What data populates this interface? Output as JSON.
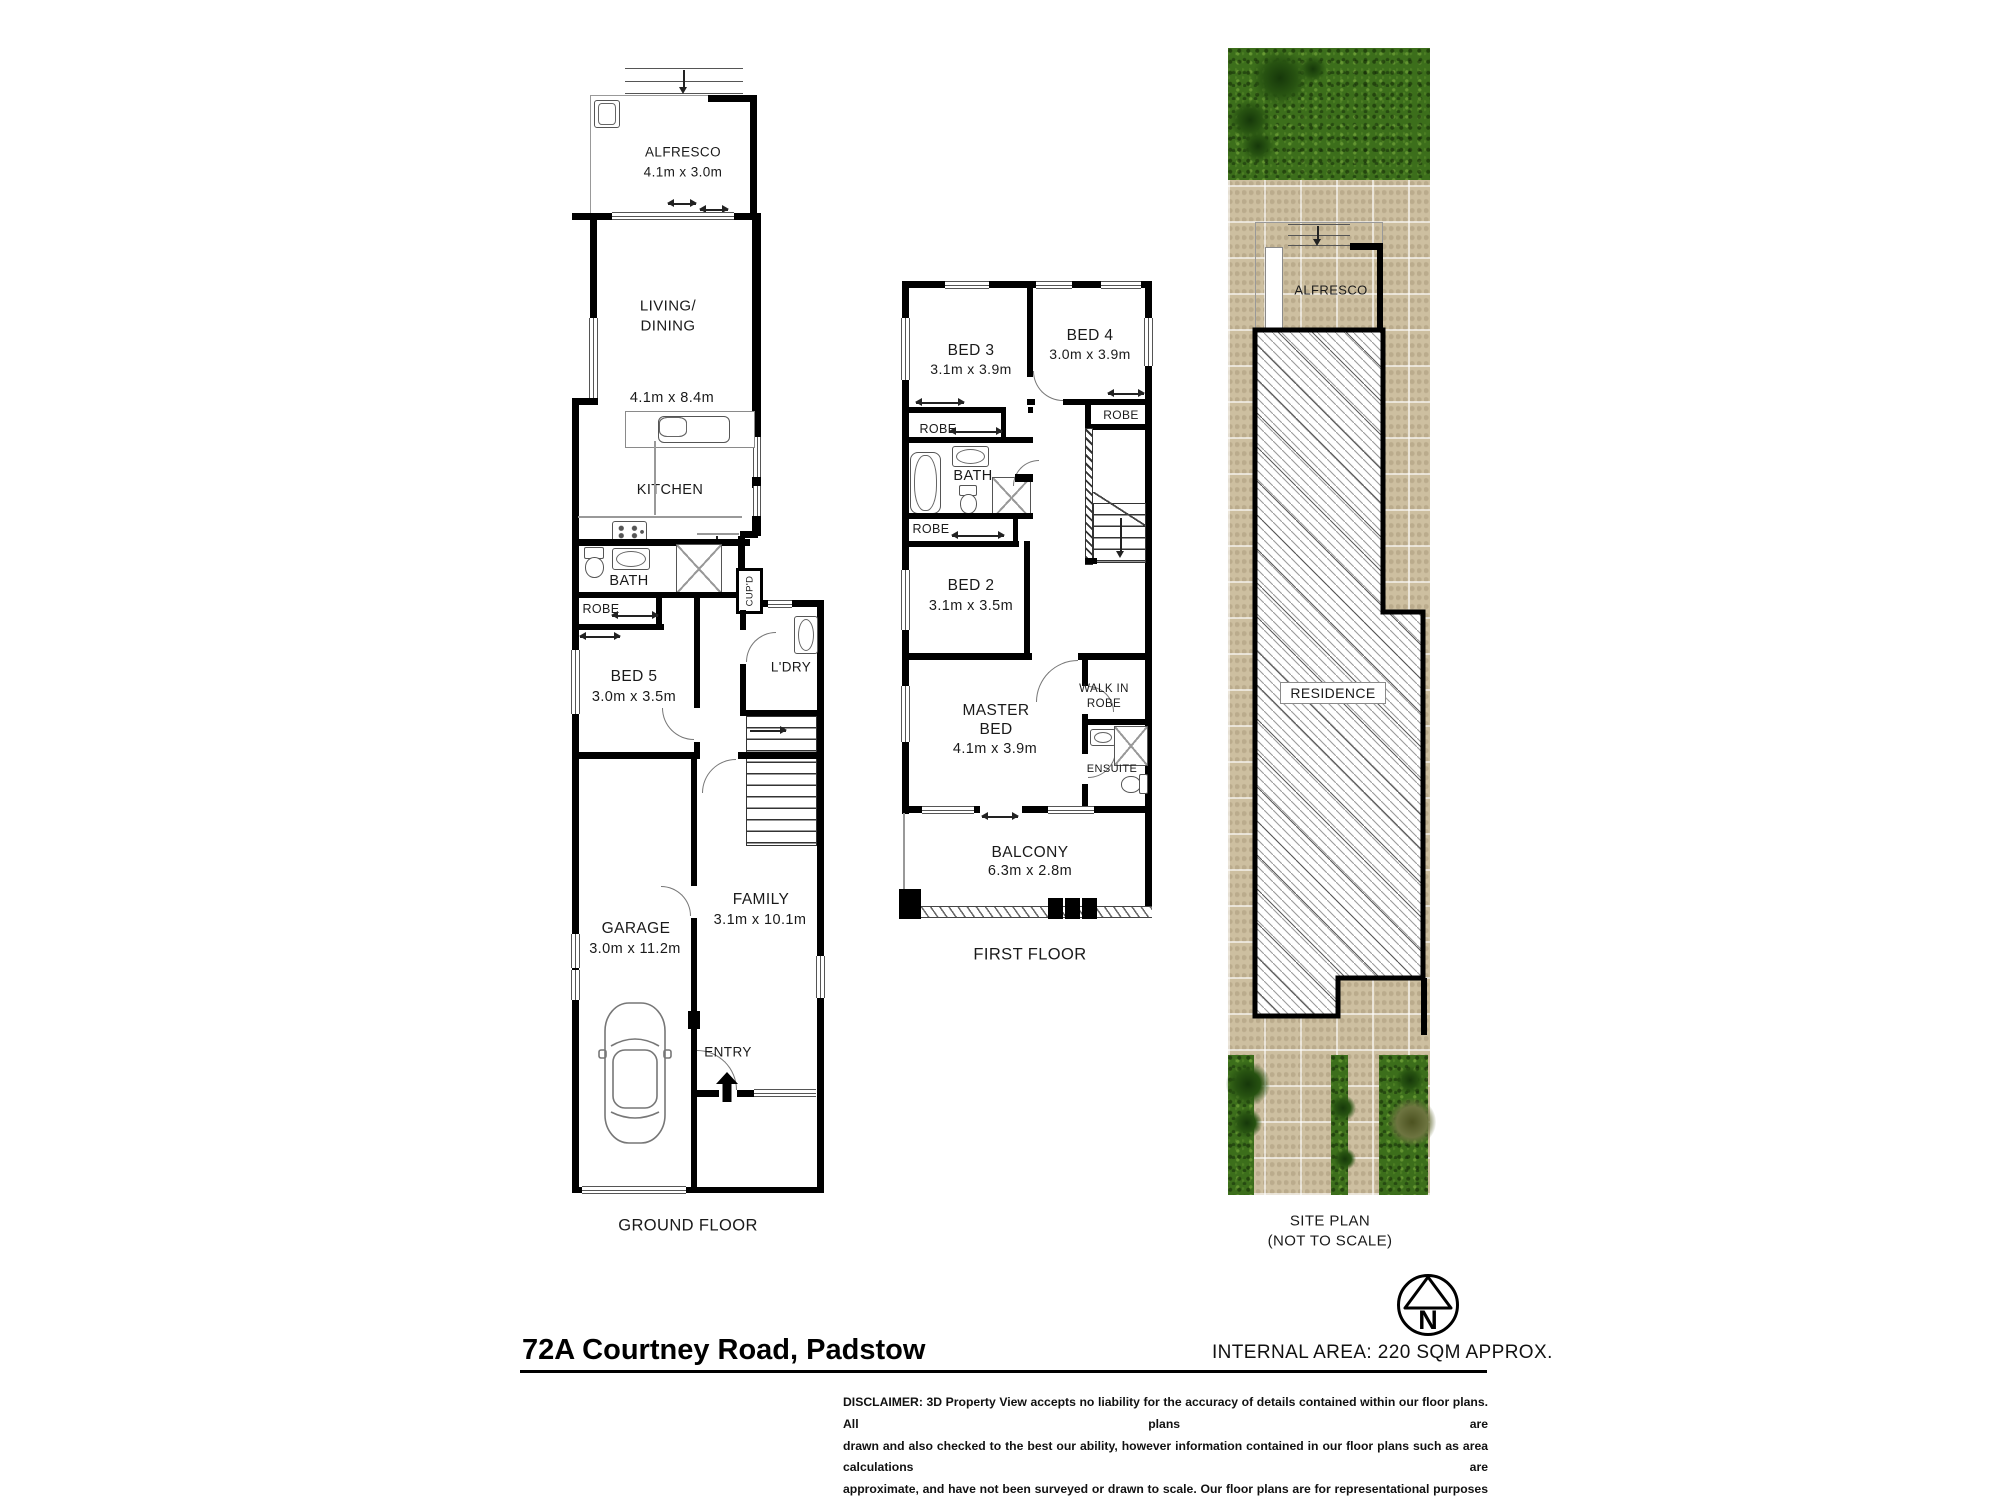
{
  "ground_floor": {
    "floor_label": "GROUND FLOOR",
    "alfresco": "ALFRESCO",
    "alfresco_dims": "4.1m x 3.0m",
    "living_line1": "LIVING/",
    "living_line2": "DINING",
    "living_dims": "4.1m x 8.4m",
    "kitchen": "KITCHEN",
    "bath": "BATH",
    "robe": "ROBE",
    "bed5": "BED 5",
    "bed5_dims": "3.0m x 3.5m",
    "cupd": "CUP'D",
    "ldry": "L'DRY",
    "garage": "GARAGE",
    "garage_dims": "3.0m x 11.2m",
    "family": "FAMILY",
    "family_dims": "3.1m x 10.1m",
    "entry": "ENTRY"
  },
  "first_floor": {
    "floor_label": "FIRST FLOOR",
    "bed3": "BED 3",
    "bed3_dims": "3.1m x 3.9m",
    "bed4": "BED 4",
    "bed4_dims": "3.0m x 3.9m",
    "robe3": "ROBE",
    "robe4": "ROBE",
    "robe2": "ROBE",
    "bath": "BATH",
    "bed2": "BED 2",
    "bed2_dims": "3.1m x 3.5m",
    "master_line1": "MASTER",
    "master_line2": "BED",
    "master_dims": "4.1m x 3.9m",
    "wir_line1": "WALK IN",
    "wir_line2": "ROBE",
    "ensuite": "ENSUITE",
    "balcony": "BALCONY",
    "balcony_dims": "6.3m x 2.8m"
  },
  "site_plan": {
    "alfresco": "ALFRESCO",
    "residence": "RESIDENCE",
    "label_line1": "SITE PLAN",
    "label_line2": "(NOT TO SCALE)"
  },
  "footer": {
    "address": "72A Courtney Road, Padstow",
    "internal_area": "INTERNAL AREA: 220 SQM APPROX.",
    "north_letter": "N",
    "disclaimer_lines": [
      "DISCLAIMER: 3D Property View accepts no liability for the accuracy of details contained within our floor plans. All plans are",
      "drawn and also checked to the best our ability, however information contained in our floor plans such as area calculations are",
      "approximate, and have not been surveyed or drawn to scale. Our floor plans are for representational purposes only and should",
      "be used as such. Do not attempt to refer to our floor plans for structural or detailed information."
    ]
  },
  "colors": {
    "wall": "#000000",
    "grass": "#3c6e1b",
    "paving": "#cdbfa0",
    "hatch_line": "#8f8f8f"
  }
}
